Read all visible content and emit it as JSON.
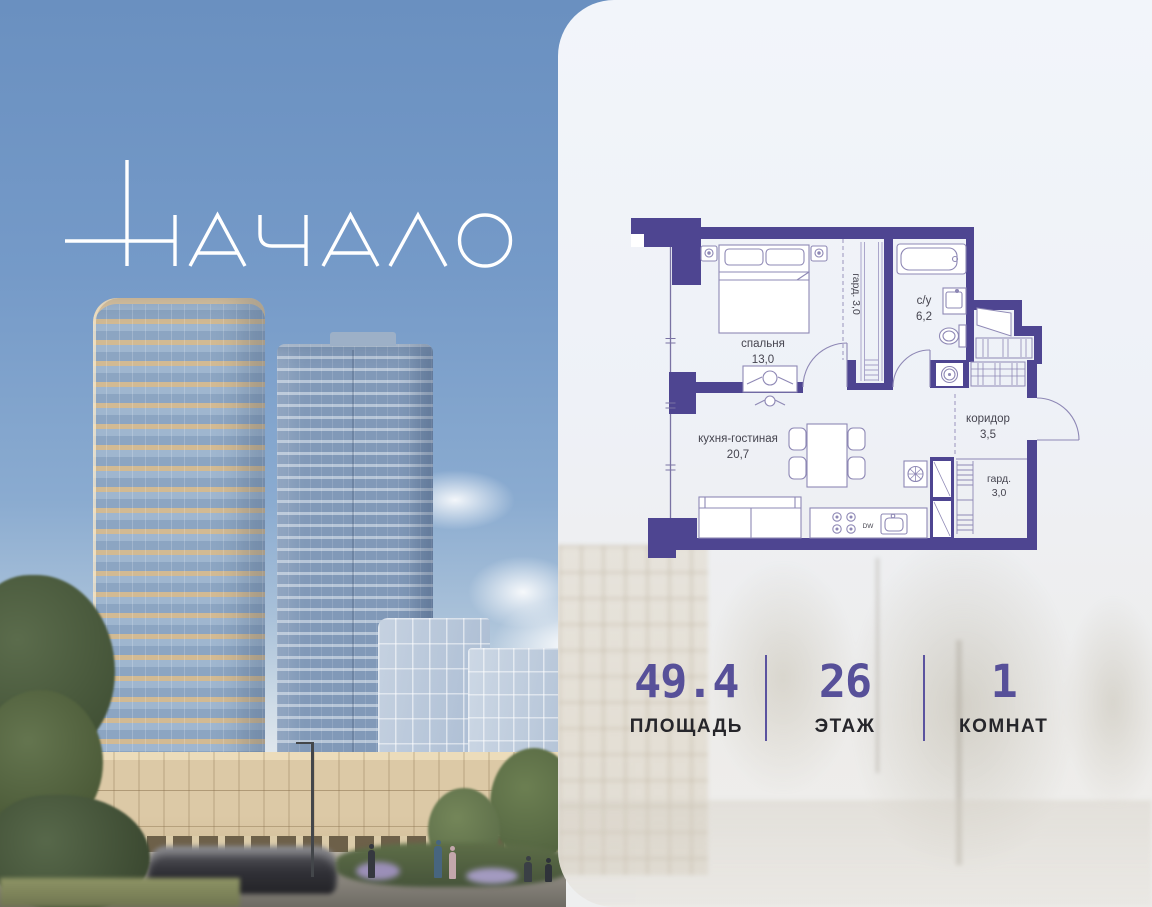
{
  "logo": {
    "text": "НАЧАЛО"
  },
  "colors": {
    "accent_purple": "#575099",
    "plan_wall": "#4e4591",
    "logo_color": "#ffffff",
    "stat_label": "#26262b"
  },
  "floor_plan": {
    "rooms": [
      {
        "name": "спальня",
        "area": "13,0"
      },
      {
        "name": "гард.",
        "area": "3,0",
        "text": "гард. 3,0"
      },
      {
        "name": "с/у",
        "area": "6,2"
      },
      {
        "name": "кухня-гостиная",
        "area": "20,7"
      },
      {
        "name": "коридор",
        "area": "3,5"
      },
      {
        "name": "гард.",
        "area": "3,0"
      }
    ],
    "appliances": {
      "dishwasher": "DW"
    }
  },
  "stats": {
    "items": [
      {
        "value": "49.4",
        "label": "ПЛОЩАДЬ"
      },
      {
        "value": "26",
        "label": "ЭТАЖ"
      },
      {
        "value": "1",
        "label": "КОМНАТ"
      }
    ]
  }
}
